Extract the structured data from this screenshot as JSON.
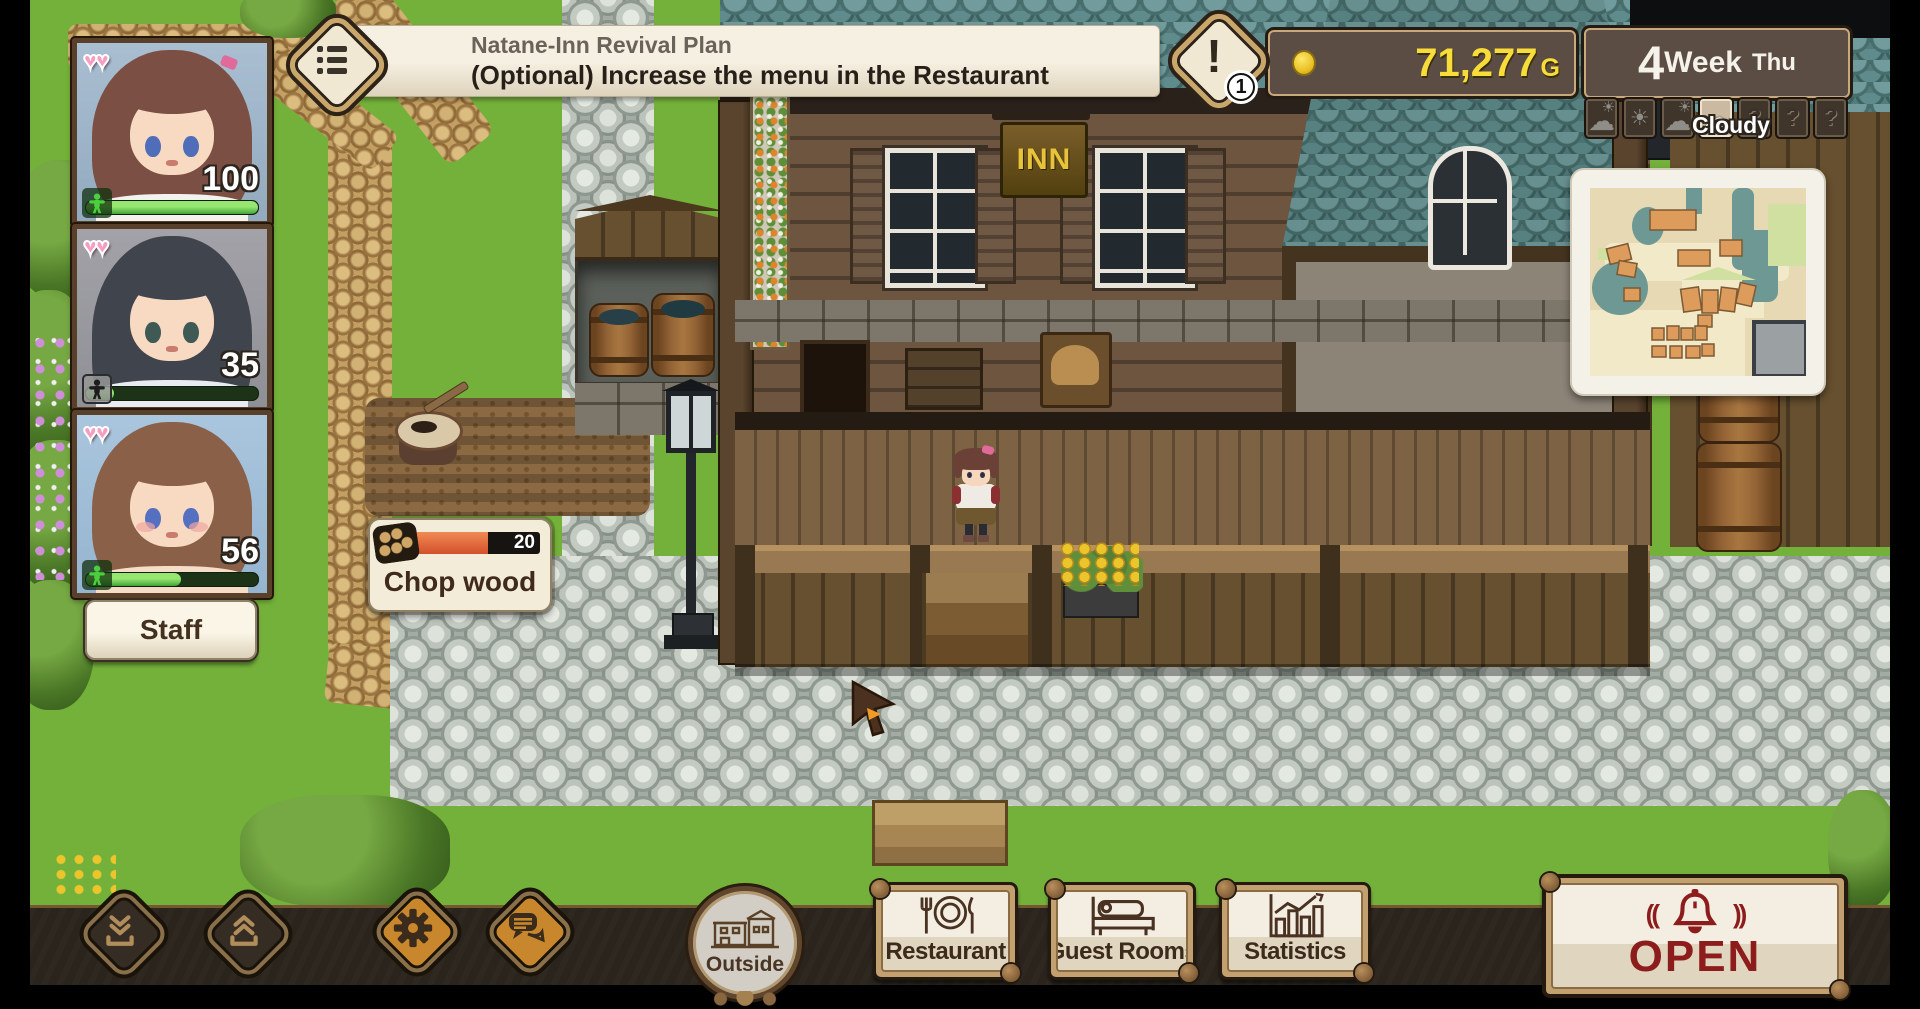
{
  "quest_banner": {
    "icon": "quest-list-icon",
    "title": "Natane-Inn Revival Plan",
    "subtitle": "(Optional) Increase the menu in the Restaurant",
    "alert_icon": "exclamation-icon",
    "alert_count": "1"
  },
  "resources": {
    "coin_icon": "coin-icon",
    "gold_amount": "71,277",
    "gold_suffix": "G"
  },
  "calendar": {
    "week_number": "4",
    "week_label": "Week",
    "day": "Thu"
  },
  "weather": {
    "current_label": "Cloudy",
    "unknown_glyph": "?",
    "selected_index": 3,
    "forecast": [
      "partly",
      "sunny",
      "partly",
      "cloudy",
      "unknown",
      "unknown",
      "unknown"
    ]
  },
  "party": {
    "staff_button_label": "Staff",
    "members": [
      {
        "hearts": "♥♥",
        "stamina": "100",
        "bar_percent": 100,
        "icon": "person-icon-green"
      },
      {
        "hearts": "♥♥",
        "stamina": "35",
        "bar_percent": 16,
        "icon": "person-icon-dark"
      },
      {
        "hearts": "♥♥",
        "stamina": "56",
        "bar_percent": 55,
        "icon": "person-icon-green"
      }
    ]
  },
  "task_tooltip": {
    "icon": "wood-pile-icon",
    "value": "20",
    "progress_percent": 62,
    "label": "Chop wood"
  },
  "scene": {
    "inn_sign": "INN"
  },
  "bottom_bar": {
    "save_icon": "save-icon",
    "load_icon": "load-icon",
    "settings_icon": "gear-icon",
    "chat_icon": "chat-icon",
    "outside_button": {
      "label": "Outside",
      "icon": "house-icon"
    },
    "nav_buttons": [
      {
        "label": "Restaurant",
        "icon": "restaurant-icon"
      },
      {
        "label": "Guest Rooms",
        "icon": "bed-icon"
      },
      {
        "label": "Statistics",
        "icon": "stats-icon"
      }
    ],
    "open_button": {
      "label": "OPEN",
      "icon": "bell-icon"
    }
  },
  "colors": {
    "gold_text": "#f8dd3a",
    "open_red": "#8d1d1d",
    "hud_panel": "#5b4d44",
    "panel_cream": "#f3ecd9",
    "stamina_green": "#57c447",
    "progress_orange": "#e06a3a",
    "accent_tan": "#c9a86d"
  }
}
